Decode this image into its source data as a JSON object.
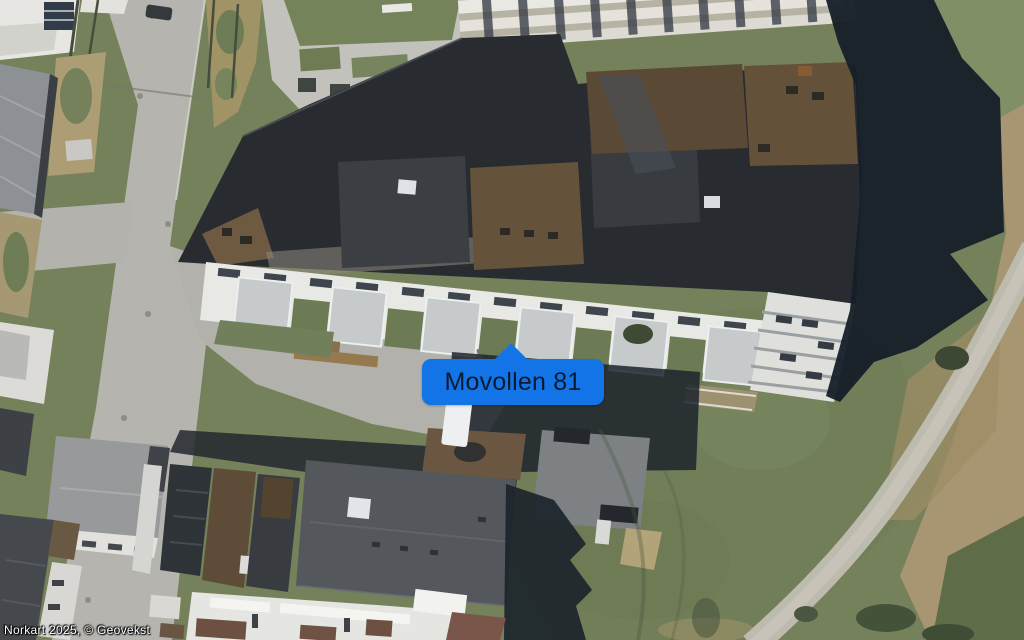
{
  "map": {
    "marker": {
      "label": "Movollen 81",
      "bg_color": "#1374e8",
      "text_color": "#0a1b2e"
    },
    "attribution": {
      "text": "Norkart 2025, © Geovekst",
      "text_color": "#ffffff"
    }
  }
}
